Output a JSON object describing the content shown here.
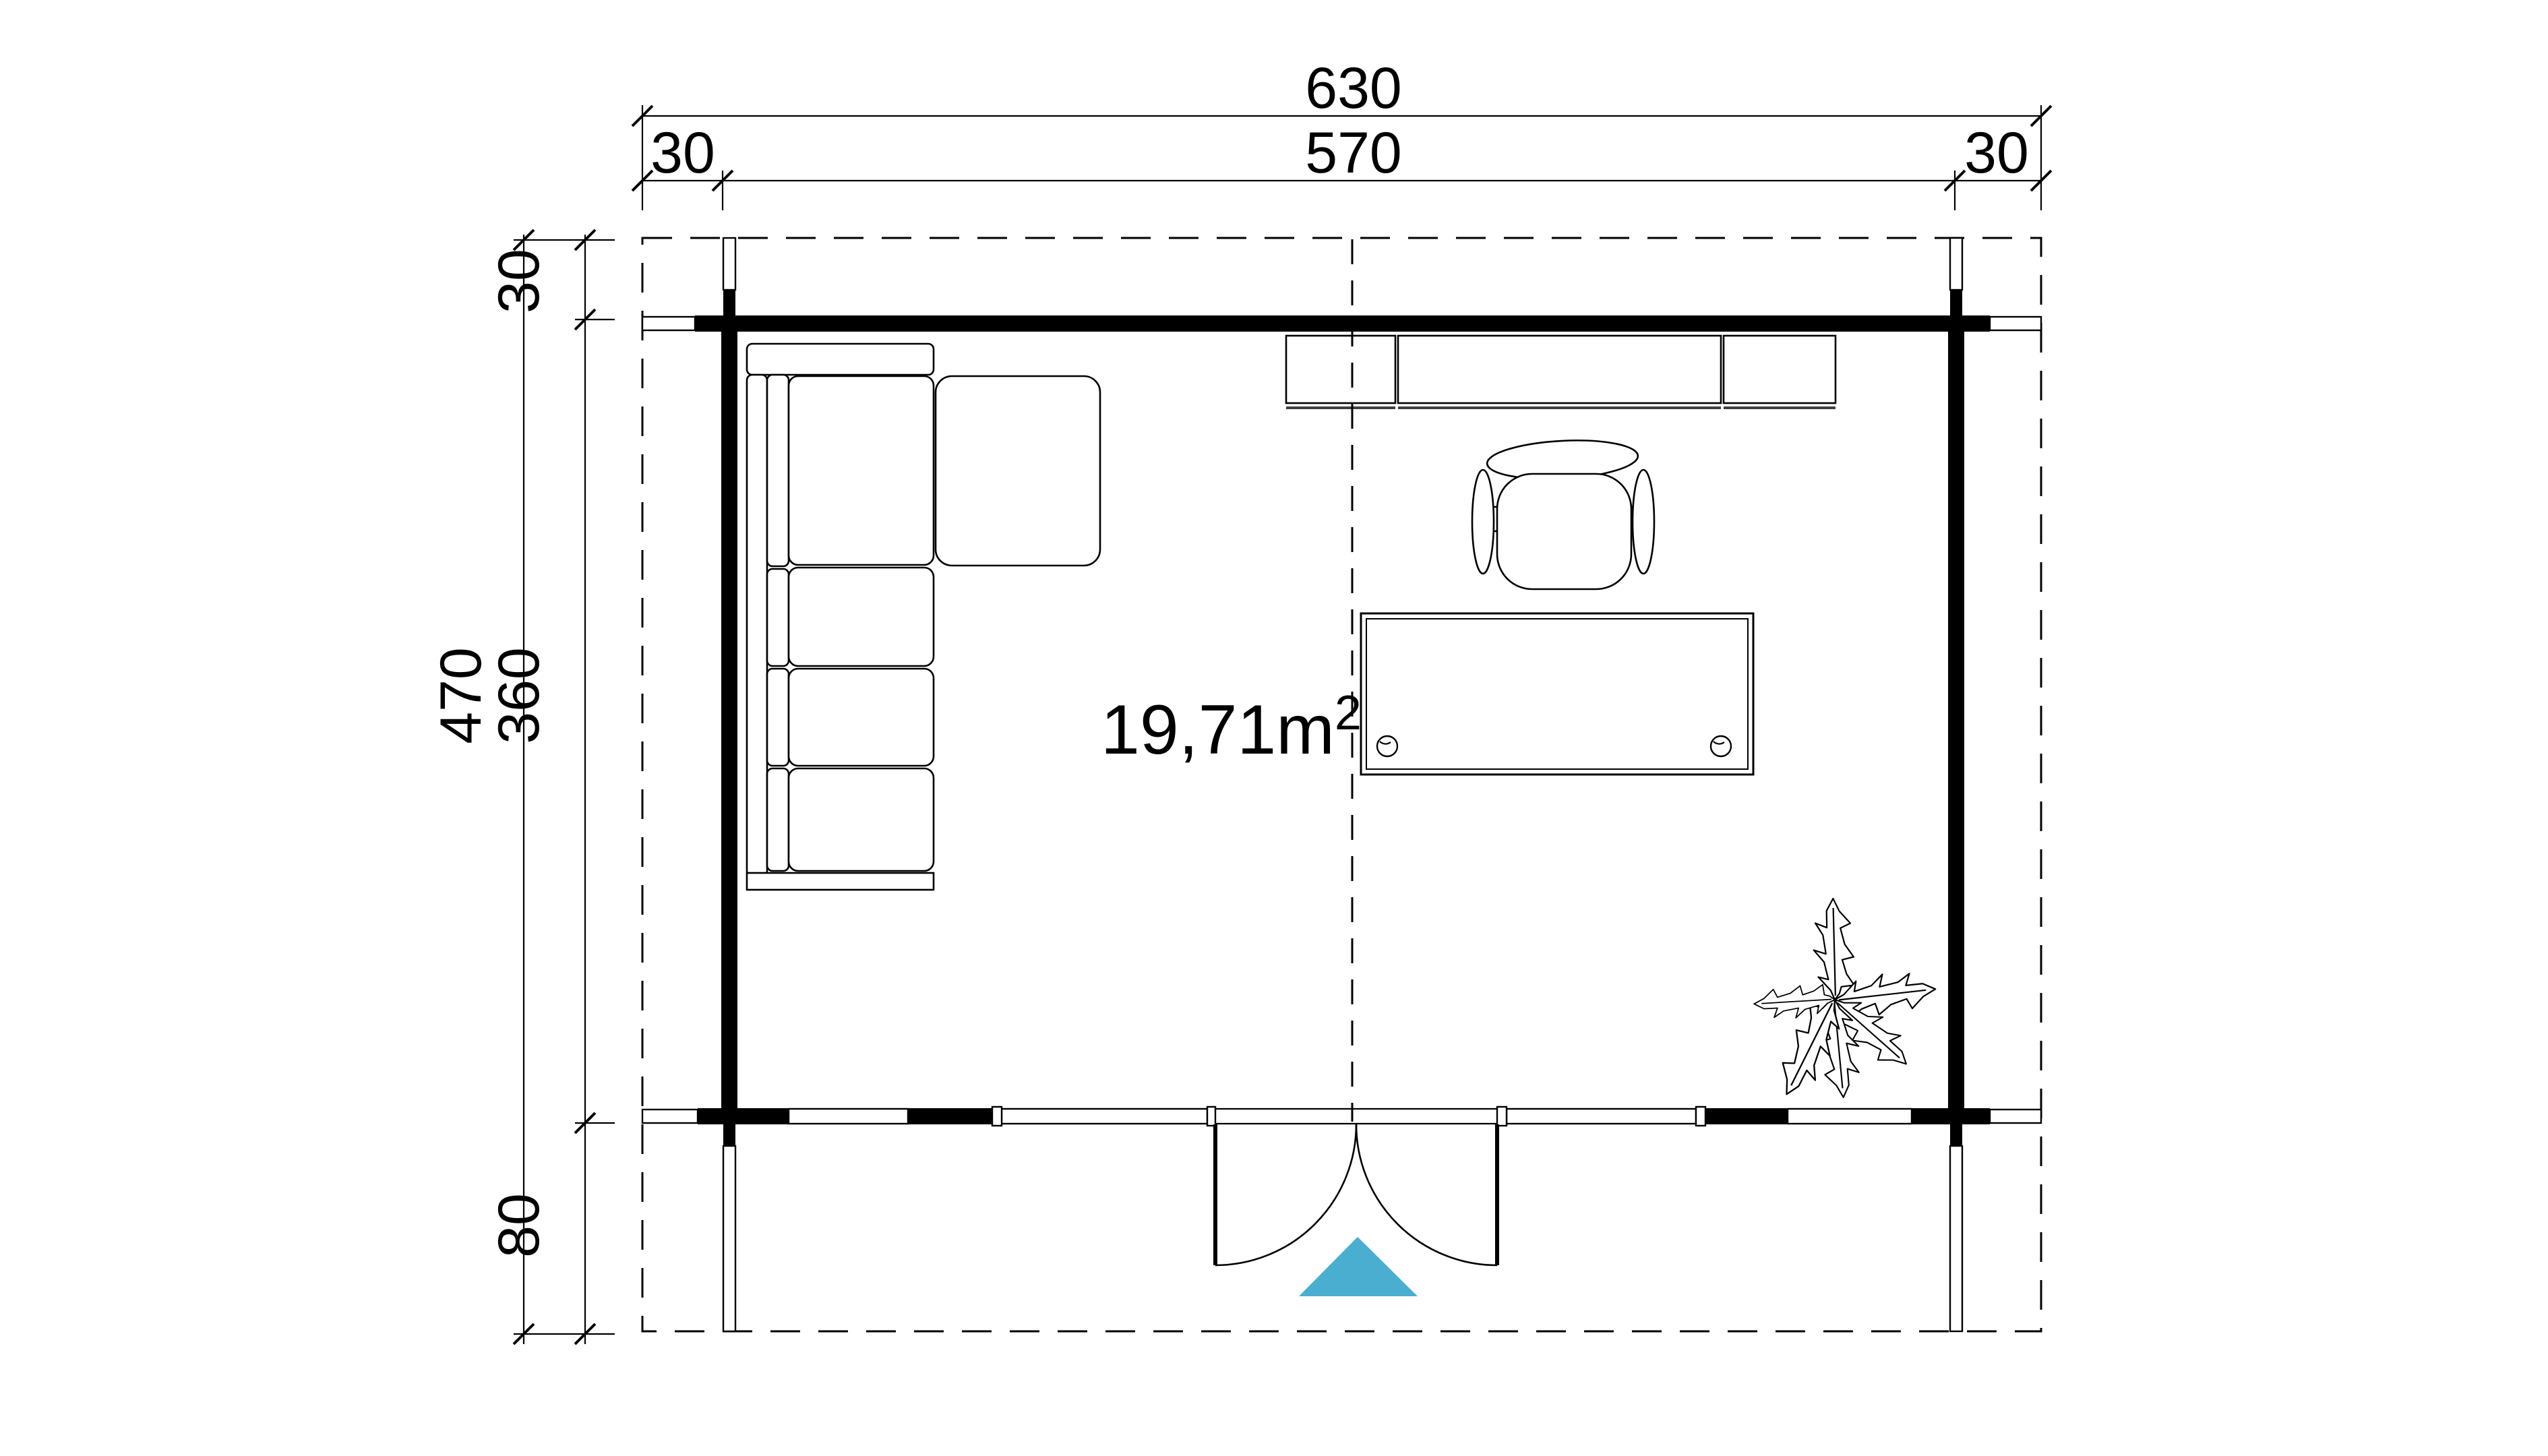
{
  "drawing": {
    "type": "floor-plan",
    "area_label": {
      "value": "19,71m",
      "superscript": "2",
      "display": "19,71m²"
    },
    "dimensions_top": {
      "overall": "630",
      "inner": "570",
      "overhang_left": "30",
      "overhang_right": "30"
    },
    "dimensions_left": {
      "overall": "470",
      "inner": "360",
      "overhang_top": "30",
      "porch_depth": "80"
    },
    "colors": {
      "ink": "#000000",
      "paper": "#ffffff",
      "entrance_arrow": "#49AECF",
      "shelf_shadow": "#3f3f3f"
    },
    "icons": {
      "sofa": "corner-sofa",
      "chair": "office-chair",
      "desk": "desk-with-grommets",
      "shelves": "wall-shelves",
      "plant": "potted-plant",
      "arrow": "entrance-arrow"
    }
  }
}
